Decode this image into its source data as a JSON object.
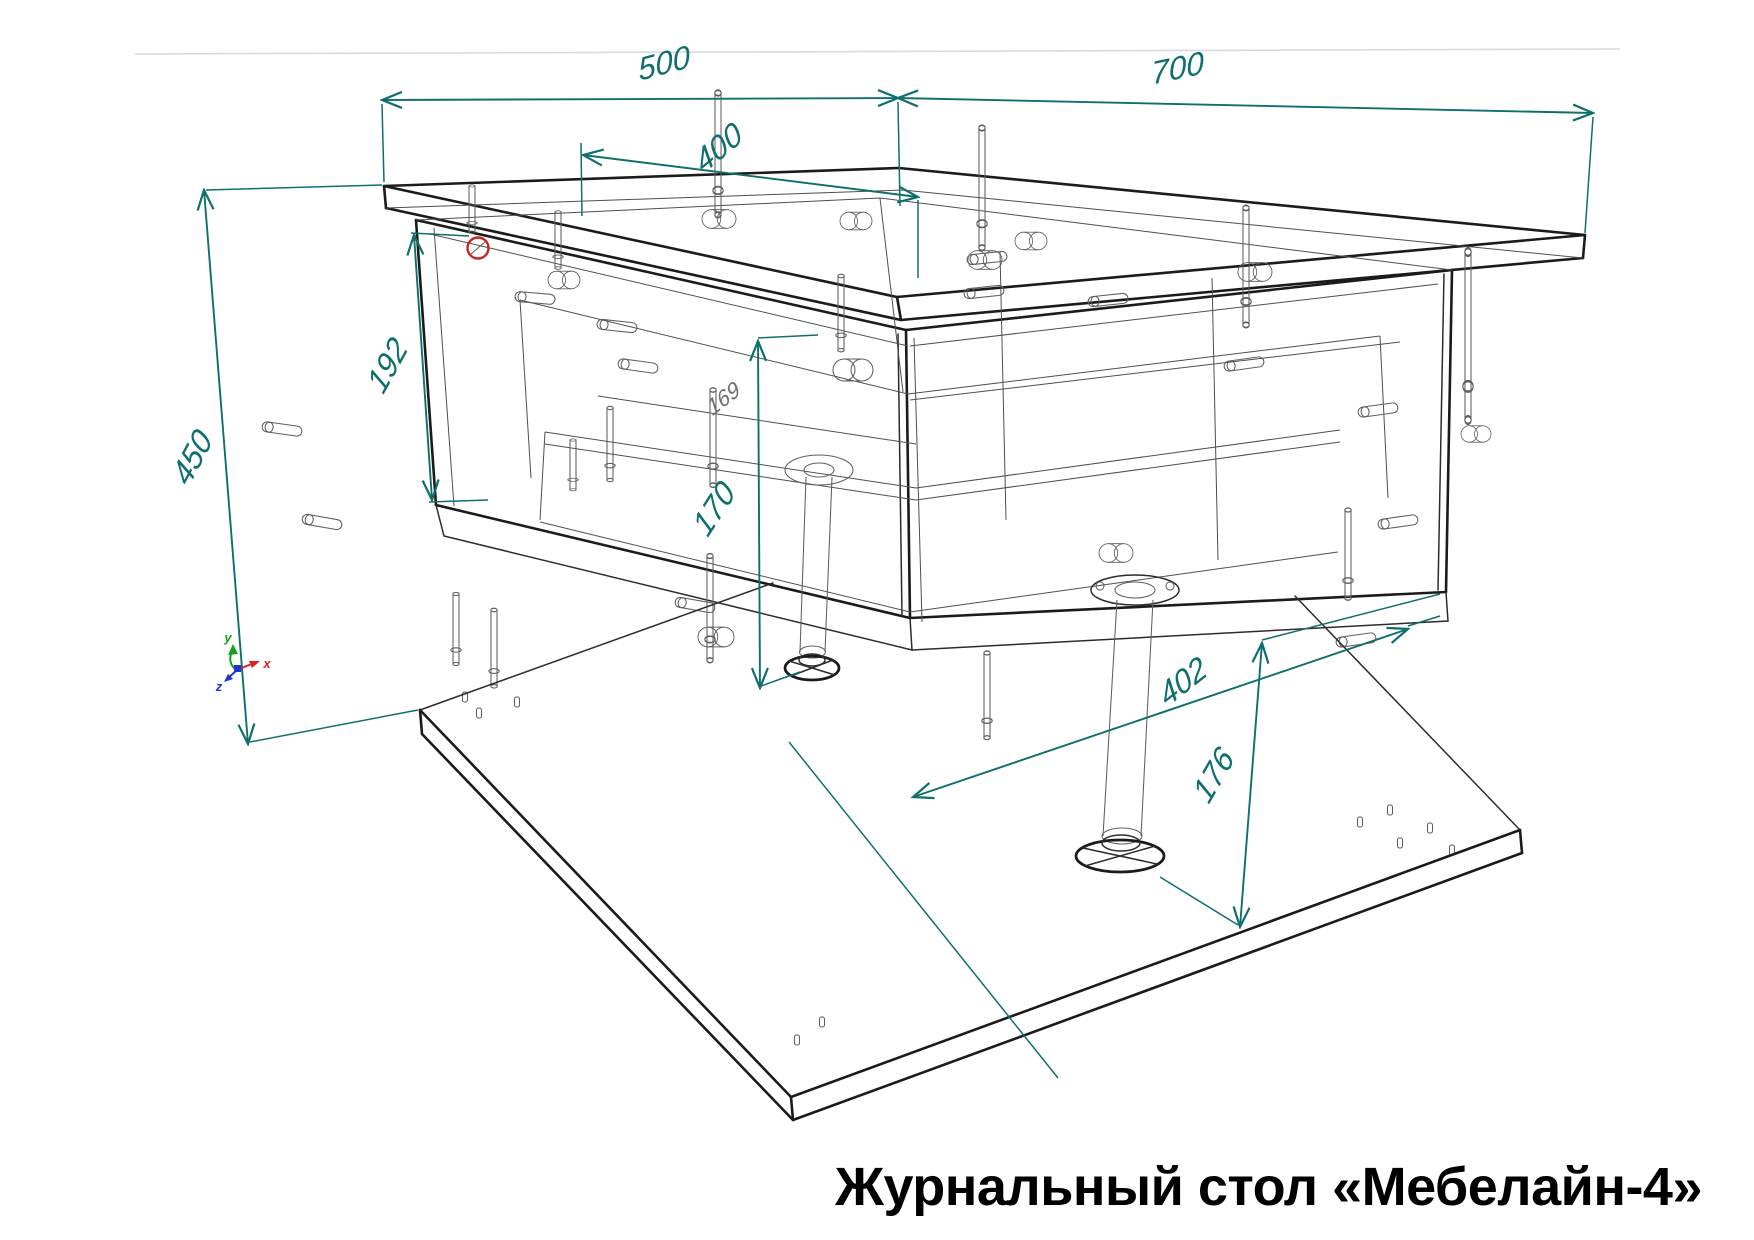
{
  "title": {
    "text": "Журнальный стол «Мебелайн-4»"
  },
  "dimensions": {
    "top_width": "500",
    "top_depth": "700",
    "inner_width": "400",
    "total_height": "450",
    "box_height": "192",
    "under_clearance": "170",
    "inner_depth_note": "169",
    "shelf_span": "402",
    "leg_clearance": "176"
  },
  "ucs": {
    "x_label": "x",
    "y_label": "y",
    "z_label": "z"
  },
  "colors": {
    "dimension_lines": "#0f6f6d",
    "drawing_outline": "#1b1b1b",
    "hardware_lines": "#5f5f5f",
    "detail_marker": "#cc2222",
    "axis_x": "#dd2222",
    "axis_y": "#18a018",
    "axis_z": "#2233cc",
    "title_text": "#000000",
    "background": "#ffffff"
  }
}
